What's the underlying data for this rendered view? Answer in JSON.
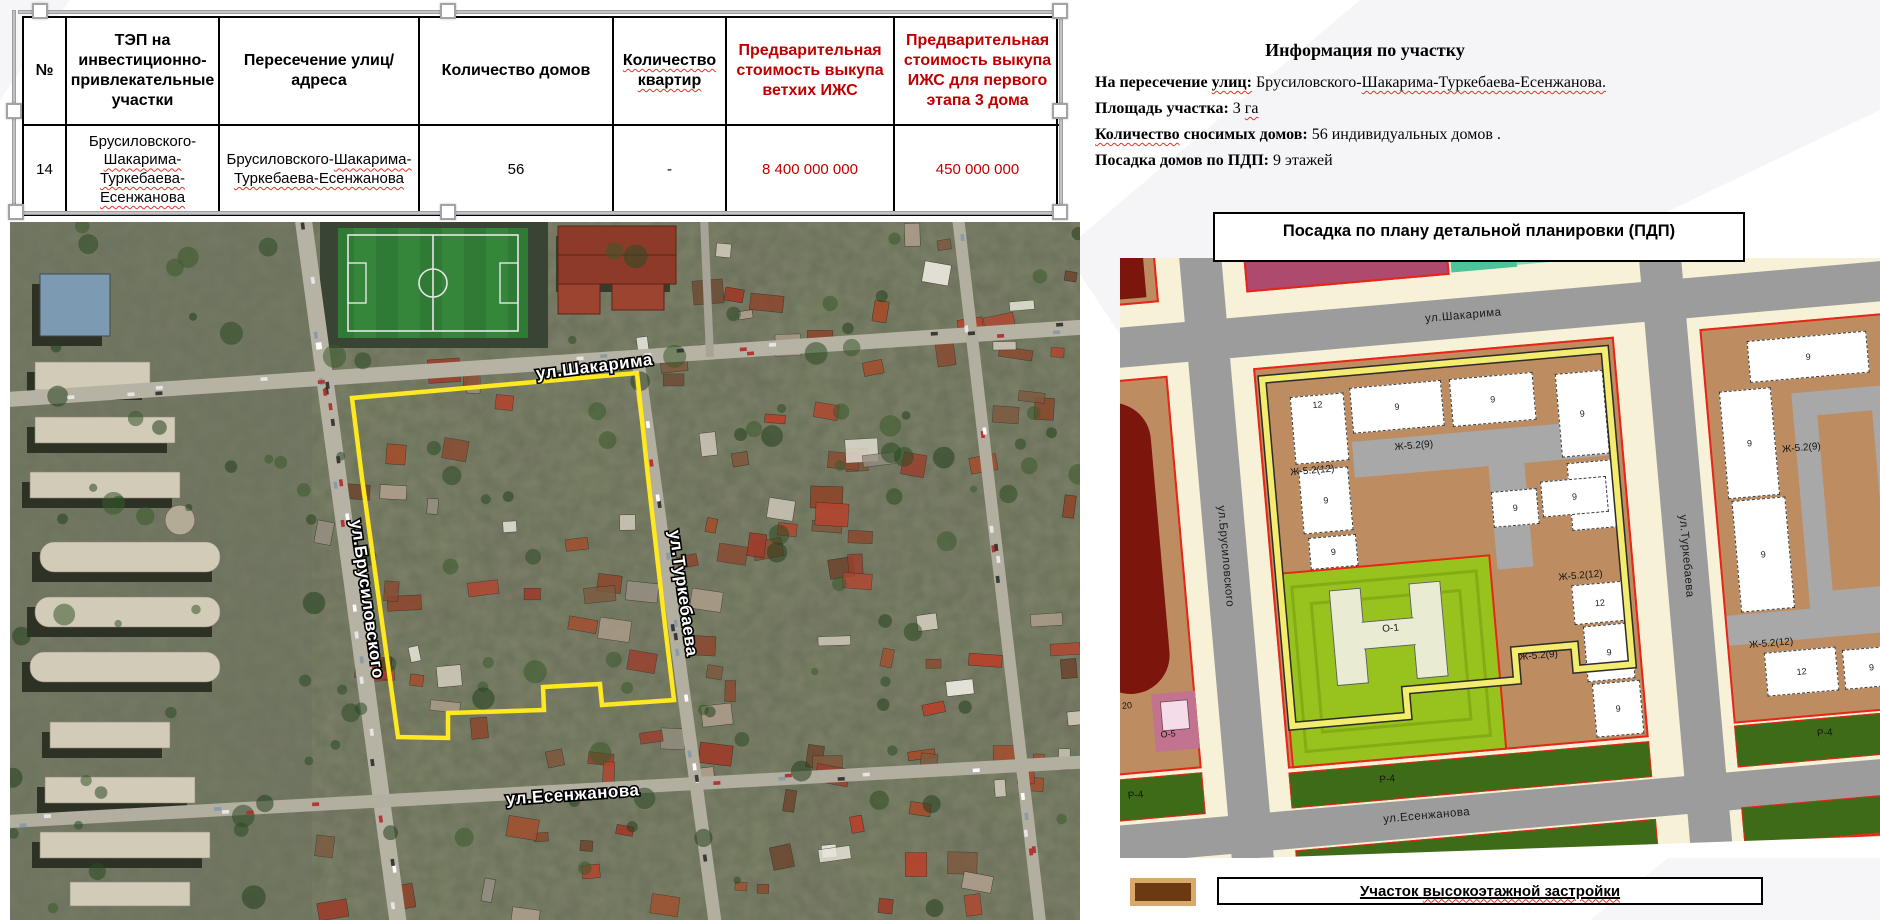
{
  "accent_red": "#c00000",
  "boundary_yellow": "#ffe81f",
  "table": {
    "headers": [
      "№",
      "ТЭП на инвестиционно-привлекательные участки",
      "Пересечение улиц/адреса",
      "Количество домов",
      "Количество квартир",
      "Предварительная стоимость выкупа ветхих ИЖС",
      "Предварительная стоимость выкупа ИЖС для первого этапа 3 дома"
    ],
    "row": {
      "num": "14",
      "houses": "56",
      "flats": "-",
      "cost_old": "8 400 000 000",
      "cost_first": "450 000 000"
    },
    "row_site_segments": [
      {
        "t": "Брусиловского-"
      },
      {
        "t": "Шакарима-",
        "w": 1
      },
      {
        "t": "Туркебаева-",
        "w": 1
      },
      {
        "t": "Есенжанова",
        "w": 1
      }
    ],
    "row_cross_segments": [
      {
        "t": "Брусиловского-"
      },
      {
        "t": "Шакарима-Туркебаева-",
        "w": 1
      },
      {
        "t": "Есенжанова",
        "w": 1
      }
    ]
  },
  "info": {
    "title": "Информация по участку",
    "lines": [
      [
        {
          "t": "На пересечение ",
          "b": 1
        },
        {
          "t": "улиц:",
          "b": 1,
          "w": 1
        },
        {
          "t": " Брусиловского-"
        },
        {
          "t": "Шакарима-Туркебаева-Есенжанова.",
          "w": 1
        }
      ],
      [
        {
          "t": "Площадь участка:",
          "b": 1
        },
        {
          "t": " 3 "
        },
        {
          "t": "га",
          "w": 1
        }
      ],
      [
        {
          "t": "Количество",
          "b": 1,
          "w": 1
        },
        {
          "t": " сносимых домов:",
          "b": 1
        },
        {
          "t": " 56 индивидуальных домов ."
        }
      ],
      [
        {
          "t": "Посадка домов по ПДП:",
          "b": 1
        },
        {
          "t": " 9 этажей"
        }
      ]
    ]
  },
  "pdp_title": "Посадка по плану детальной планировки  (ПДП)",
  "legend": {
    "label": "Участок высокоэтажной застройки"
  },
  "streets": {
    "shakarima": "ул.Шакарима",
    "brusilovskogo": "ул.Брусиловского",
    "turkebaeva": "ул.Туркебаева",
    "esenzhanova": "ул.Есенжанова"
  },
  "pdp_labels": {
    "zh6": "Ж-6",
    "n20": "20",
    "o5": "О-5",
    "o3": "О-3",
    "o1": "О-1",
    "r4": "Р-4",
    "zh529": "Ж-5.2(9)",
    "zh5212": "Ж-5.2(12)",
    "n9": "9",
    "n12": "12"
  }
}
